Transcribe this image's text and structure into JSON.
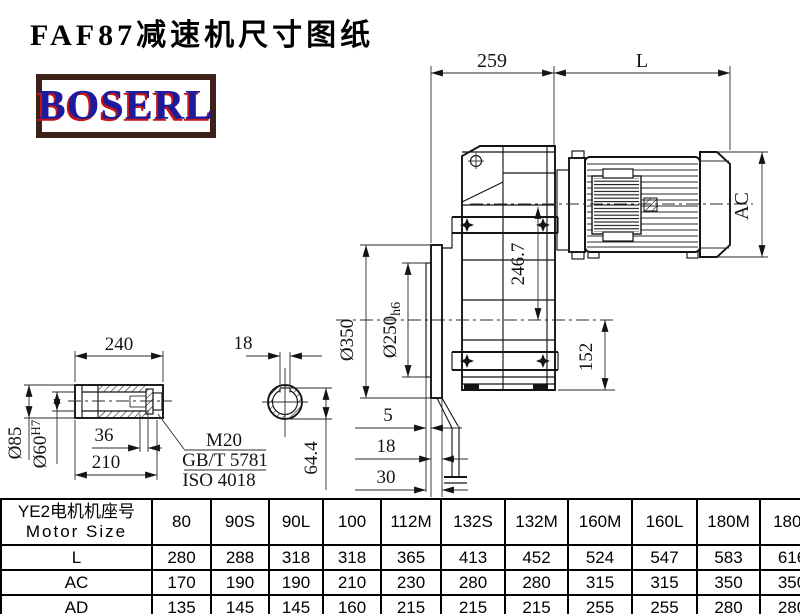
{
  "title": "FAF87减速机尺寸图纸",
  "logo": {
    "text": "BOSERL",
    "text_color": "#1b1b9e",
    "shadow_color": "#c41414",
    "border_color": "#3d2018"
  },
  "drawing": {
    "d259": "259",
    "dL": "L",
    "dAC": "AC",
    "d350": "Ø350",
    "d250": "Ø250",
    "d250_suffix": "h6",
    "d2467": "246.7",
    "d152": "152",
    "d5": "5",
    "d18_side": "18",
    "d30": "30",
    "d240": "240",
    "d85": "Ø85",
    "d60": "Ø60",
    "d60_suffix": "H7",
    "d36": "36",
    "d210": "210",
    "leader1": "M20",
    "leader2": "GB/T 5781",
    "leader3": "ISO 4018",
    "d18_key": "18",
    "d644": "64.4"
  },
  "table": {
    "row_header": {
      "cn": "YE2电机机座号",
      "en": "Motor Size"
    },
    "columns": [
      "80",
      "90S",
      "90L",
      "100",
      "112M",
      "132S",
      "132M",
      "160M",
      "160L",
      "180M",
      "180L"
    ],
    "rows": [
      {
        "label": "L",
        "values": [
          "280",
          "288",
          "318",
          "318",
          "365",
          "413",
          "452",
          "524",
          "547",
          "583",
          "616"
        ]
      },
      {
        "label": "AC",
        "values": [
          "170",
          "190",
          "190",
          "210",
          "230",
          "280",
          "280",
          "315",
          "315",
          "350",
          "350"
        ]
      },
      {
        "label": "AD",
        "values": [
          "135",
          "145",
          "145",
          "160",
          "215",
          "215",
          "215",
          "255",
          "255",
          "280",
          "280"
        ]
      }
    ]
  }
}
